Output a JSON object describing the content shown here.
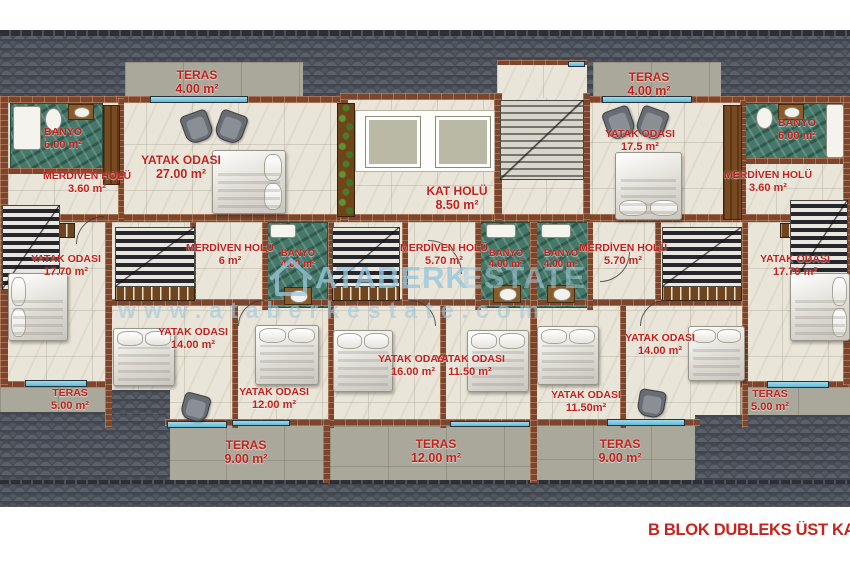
{
  "title": "B BLOK DUBLEKS ÜST KAT P",
  "watermark": {
    "brand_bold": "ATABERK",
    "brand_light": "ESTATE",
    "url": "www.ataberkestate.com"
  },
  "colors": {
    "label_red": "#c3211c",
    "roof_gray": "#42464e",
    "wall_brick": "#7c452e",
    "floor_marble": "#eae5d9",
    "bathroom_green": "#46786a",
    "terrace_gray": "#a9a89a",
    "glass_blue": "#7cc5de",
    "watermark_blue": "#96c6db"
  },
  "rooms": {
    "teras_top_left": {
      "name": "TERAS",
      "area": "4.00 m²"
    },
    "banyo_top_left": {
      "name": "BANYO",
      "area": "6.00 m²"
    },
    "merdiven_top_left": {
      "name": "MERDİVEN HOLÜ",
      "area": "3.60 m²"
    },
    "yatak_top_left": {
      "name": "YATAK ODASI",
      "area": "27.00 m²"
    },
    "kat_holu": {
      "name": "KAT  HOLÜ",
      "area": "8.50 m²"
    },
    "teras_top_right": {
      "name": "TERAS",
      "area": "4.00 m²"
    },
    "yatak_top_right": {
      "name": "YATAK ODASI",
      "area": "17.5 m²"
    },
    "banyo_top_right": {
      "name": "BANYO",
      "area": "6.00 m²"
    },
    "merdiven_top_right": {
      "name": "MERDİVEN HOLÜ",
      "area": "3.60 m²"
    },
    "yatak_mid_left": {
      "name": "YATAK ODASI",
      "area": "17.70 m²"
    },
    "merdiven_mid_left": {
      "name": "MERDİVEN HOLÜ",
      "area": "6  m²"
    },
    "banyo_mid_left": {
      "name": "BANYO",
      "area": "4.00 m²"
    },
    "merdiven_mid_center": {
      "name": "MERDİVEN HOLÜ",
      "area": "5.70 m²"
    },
    "banyo_mid_center_1": {
      "name": "BANYO",
      "area": "4.00 m²"
    },
    "banyo_mid_center_2": {
      "name": "BANYO",
      "area": "4.00 m²"
    },
    "merdiven_mid_right": {
      "name": "MERDİVEN HOLÜ",
      "area": "5.70 m²"
    },
    "yatak_mid_right": {
      "name": "YATAK ODASI",
      "area": "17.70 m²"
    },
    "yatak_14_left": {
      "name": "YATAK ODASI",
      "area": "14.00 m²"
    },
    "yatak_12": {
      "name": "YATAK ODASI",
      "area": "12.00 m²"
    },
    "yatak_16": {
      "name": "YATAK ODASI",
      "area": "16.00 m²"
    },
    "yatak_1150_left": {
      "name": "YATAK ODASI",
      "area": "11.50 m²"
    },
    "yatak_1150_right": {
      "name": "YATAK ODASI",
      "area": "11.50m²"
    },
    "yatak_14_right": {
      "name": "YATAK ODASI",
      "area": "14.00 m²"
    },
    "teras_side_left": {
      "name": "TERAS",
      "area": "5.00 m²"
    },
    "teras_side_right": {
      "name": "TERAS",
      "area": "5.00 m²"
    },
    "teras_bottom_left": {
      "name": "TERAS",
      "area": "9.00 m²"
    },
    "teras_bottom_center": {
      "name": "TERAS",
      "area": "12.00 m²"
    },
    "teras_bottom_right": {
      "name": "TERAS",
      "area": "9.00 m²"
    }
  }
}
